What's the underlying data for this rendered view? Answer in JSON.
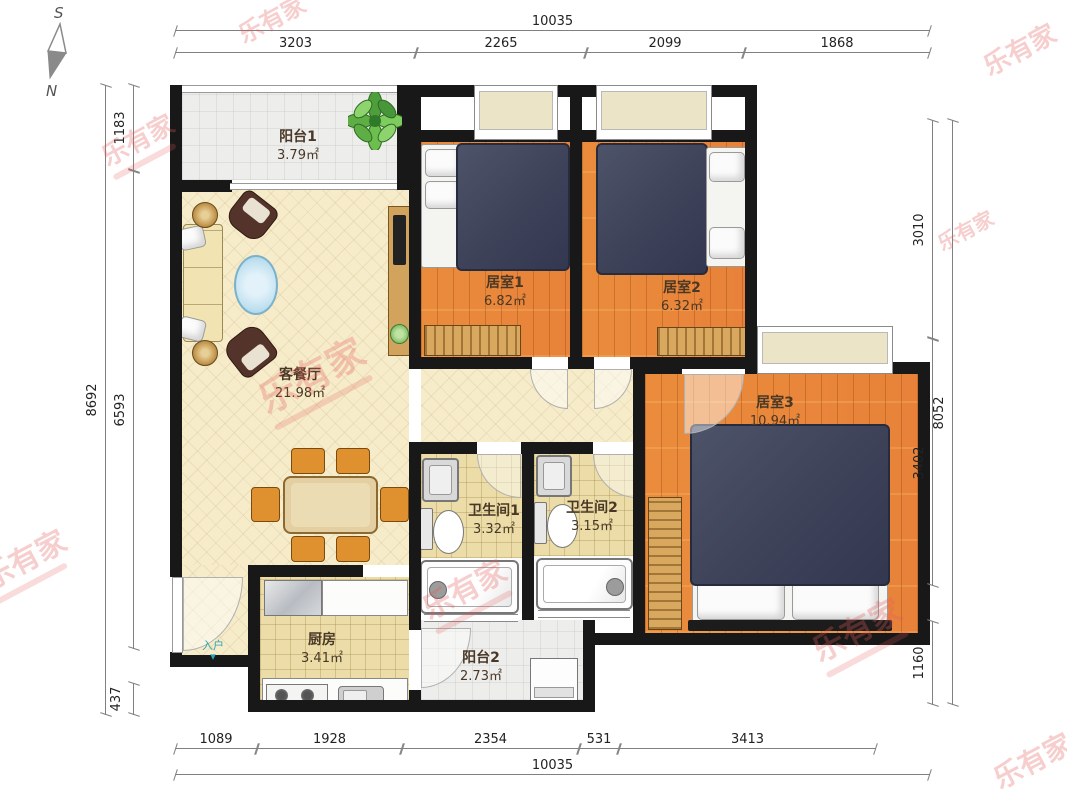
{
  "compass": {
    "south": "S",
    "north": "N"
  },
  "watermark": {
    "text": "乐有家",
    "color": "#e45c5c"
  },
  "entrance": {
    "label": "入户",
    "arrow": "▾"
  },
  "rooms": {
    "balcony1": {
      "name": "阳台1",
      "area": "3.79㎡"
    },
    "living": {
      "name": "客餐厅",
      "area": "21.98㎡"
    },
    "bedroom1": {
      "name": "居室1",
      "area": "6.82㎡"
    },
    "bedroom2": {
      "name": "居室2",
      "area": "6.32㎡"
    },
    "bedroom3": {
      "name": "居室3",
      "area": "10.94㎡"
    },
    "bath1": {
      "name": "卫生间1",
      "area": "3.32㎡"
    },
    "bath2": {
      "name": "卫生间2",
      "area": "3.15㎡"
    },
    "kitchen": {
      "name": "厨房",
      "area": "3.41㎡"
    },
    "balcony2": {
      "name": "阳台2",
      "area": "2.73㎡"
    }
  },
  "dims": {
    "top_total": "10035",
    "top_segments": [
      "3203",
      "2265",
      "2099",
      "1868"
    ],
    "bottom_segments": [
      "1089",
      "1928",
      "2354",
      "531",
      "3413"
    ],
    "bottom_total": "10035",
    "left_total": "8692",
    "left_segments": [
      "1183",
      "6593",
      "437"
    ],
    "right_total": "8052",
    "right_segments": [
      "3010",
      "3402",
      "1160"
    ]
  },
  "colors": {
    "wall": "#181818",
    "wood_floor": "#e8873a",
    "living_floor": "#f6ecca",
    "tile_floor": "#ecdda8",
    "bed": "#3d4259",
    "wardrobe": "#d9a85f"
  }
}
